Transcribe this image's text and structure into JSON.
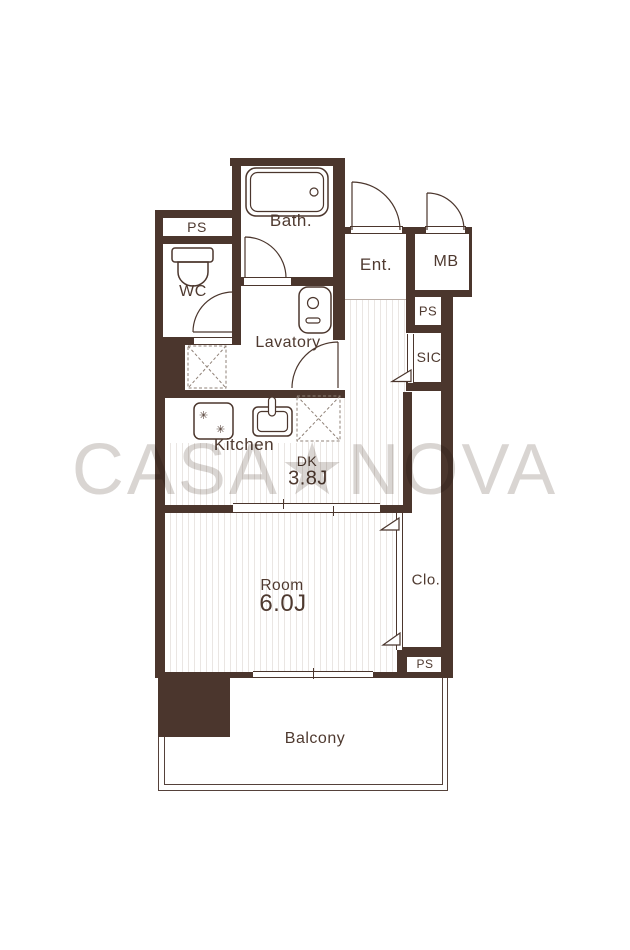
{
  "brand_watermark": {
    "text": "CASA★NOVA"
  },
  "colors": {
    "wall": "#4b362d",
    "label": "#4f3a30",
    "stripe": "#eae6e3",
    "dash": "#8f8177",
    "watermark": "#d9d5d2",
    "thin": "#55413a",
    "step": "#bbafa8"
  },
  "rooms": {
    "bath": {
      "label": "Bath."
    },
    "ps_top": {
      "label": "PS"
    },
    "wc": {
      "label": "WC"
    },
    "ent": {
      "label": "Ent."
    },
    "mb": {
      "label": "MB"
    },
    "ps_right": {
      "label": "PS"
    },
    "sic": {
      "label": "SIC"
    },
    "lavatory": {
      "label": "Lavatory"
    },
    "kitchen": {
      "label": "Kitchen"
    },
    "dk": {
      "label": "DK",
      "size": "3.8J"
    },
    "main_room": {
      "label": "Room",
      "size": "6.0J"
    },
    "closet": {
      "label": "Clo."
    },
    "ps_bottom": {
      "label": "PS"
    },
    "balcony": {
      "label": "Balcony"
    }
  },
  "fixtures": [
    "bathtub",
    "toilet",
    "wash-basin",
    "stove",
    "kitchen-sink",
    "washer-space-x",
    "refrigerator-space-x",
    "swing-doors",
    "folding-door-triangles",
    "sliding-doors"
  ]
}
